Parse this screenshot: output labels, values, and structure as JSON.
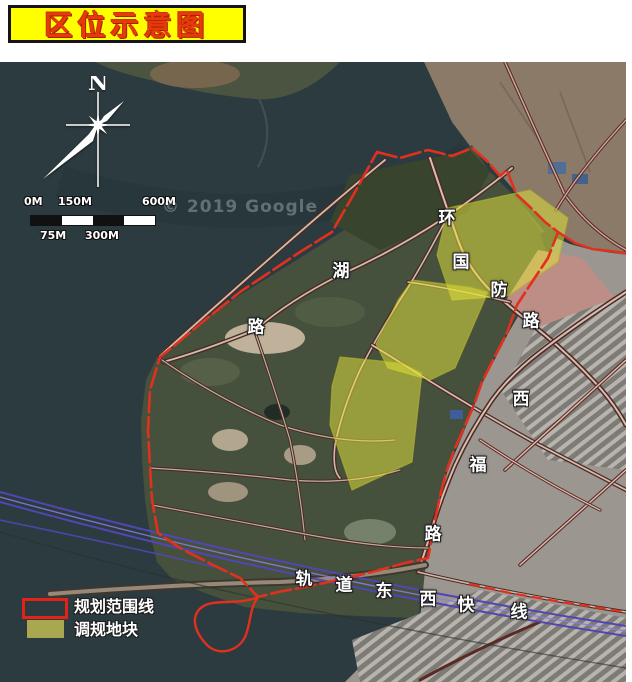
{
  "title": {
    "text": "区位示意图"
  },
  "map": {
    "compass_label": "N",
    "scale": {
      "top_labels": [
        "0M",
        "150M",
        "600M"
      ],
      "bottom_labels": [
        "75M",
        "300M"
      ]
    },
    "watermark": "© 2019 Google",
    "road_labels": [
      {
        "text": "环"
      },
      {
        "text": "国"
      },
      {
        "text": "防"
      },
      {
        "text": "路"
      },
      {
        "text": "湖"
      },
      {
        "text": "路"
      },
      {
        "text": "西"
      },
      {
        "text": "福"
      },
      {
        "text": "路"
      }
    ],
    "rail_labels": [
      {
        "text": "轨"
      },
      {
        "text": "道"
      },
      {
        "text": "东"
      },
      {
        "text": "西"
      },
      {
        "text": "快"
      },
      {
        "text": "线"
      }
    ],
    "legend": {
      "items": [
        {
          "label": "规划范围线",
          "swatch": "red-outline"
        },
        {
          "label": "调规地块",
          "swatch": "olive-fill"
        }
      ]
    },
    "colors": {
      "boundary_red": "#e2301f",
      "parcel_yellow": "#e2e43c",
      "legend_olive": "#a9a84f",
      "rail_purple": "#5146b4",
      "title_background": "#ffff00",
      "title_text": "#e8390b"
    }
  }
}
